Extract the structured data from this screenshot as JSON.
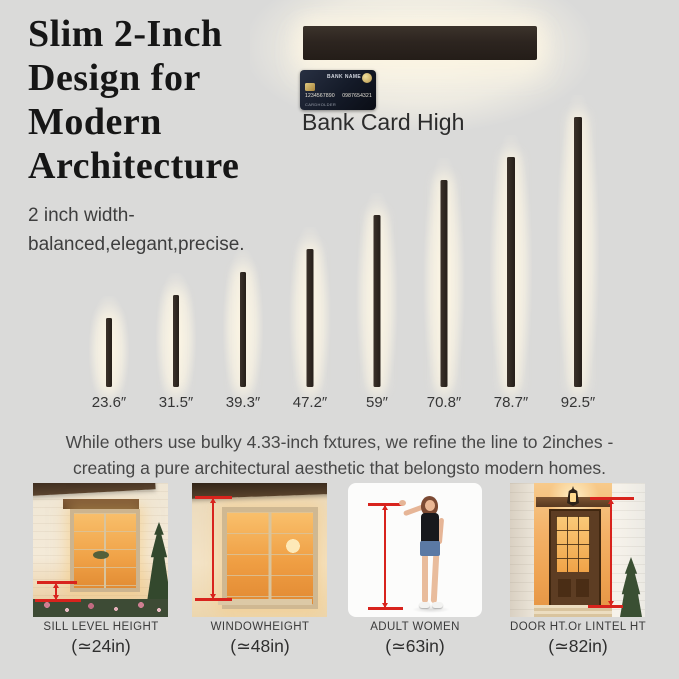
{
  "header": {
    "title_lines": [
      "Slim 2-Inch",
      "Design for",
      "Modern",
      "Architecture"
    ],
    "subtitle_lines": [
      "2 inch width-",
      "balanced,elegant,precise."
    ]
  },
  "reference": {
    "label": "Bank Card High",
    "card": {
      "bank_name": "BANK NAME",
      "number_left": "1234567890",
      "number_right": "0987654321",
      "cardholder": "CARDHOLDER"
    }
  },
  "chart_data": {
    "type": "bar",
    "title": "",
    "xlabel": "",
    "ylabel": "",
    "unit": "inches",
    "categories": [
      "23.6″",
      "31.5″",
      "39.3″",
      "47.2″",
      "59″",
      "70.8″",
      "78.7″",
      "92.5″"
    ],
    "values": [
      23.6,
      31.5,
      39.3,
      47.2,
      59,
      70.8,
      78.7,
      92.5
    ],
    "ylim": [
      0,
      92.5
    ],
    "orientation": "vertical",
    "legend": "none",
    "grid": false
  },
  "tagline": {
    "lines": [
      "While others use bulky 4.33-inch fxtures, we refine the line to 2inches -",
      "creating a pure architectural aesthetic that belongsto modern homes."
    ]
  },
  "gallery": {
    "items": [
      {
        "caption": "SILL LEVEL HEIGHT",
        "value": "(≃24in)"
      },
      {
        "caption": "WINDOWHEIGHT",
        "value": "(≃48in)"
      },
      {
        "caption": "ADULT WOMEN",
        "value": "(≃63in)"
      },
      {
        "caption": "DOOR HT.Or LINTEL HT",
        "value": "(≃82in)"
      }
    ]
  },
  "colors": {
    "background": "#dadad9",
    "fixture_bar": "#2b241e",
    "glow": "#fbf4e4",
    "accent_red": "#d8231d",
    "heading_text": "#161616"
  }
}
